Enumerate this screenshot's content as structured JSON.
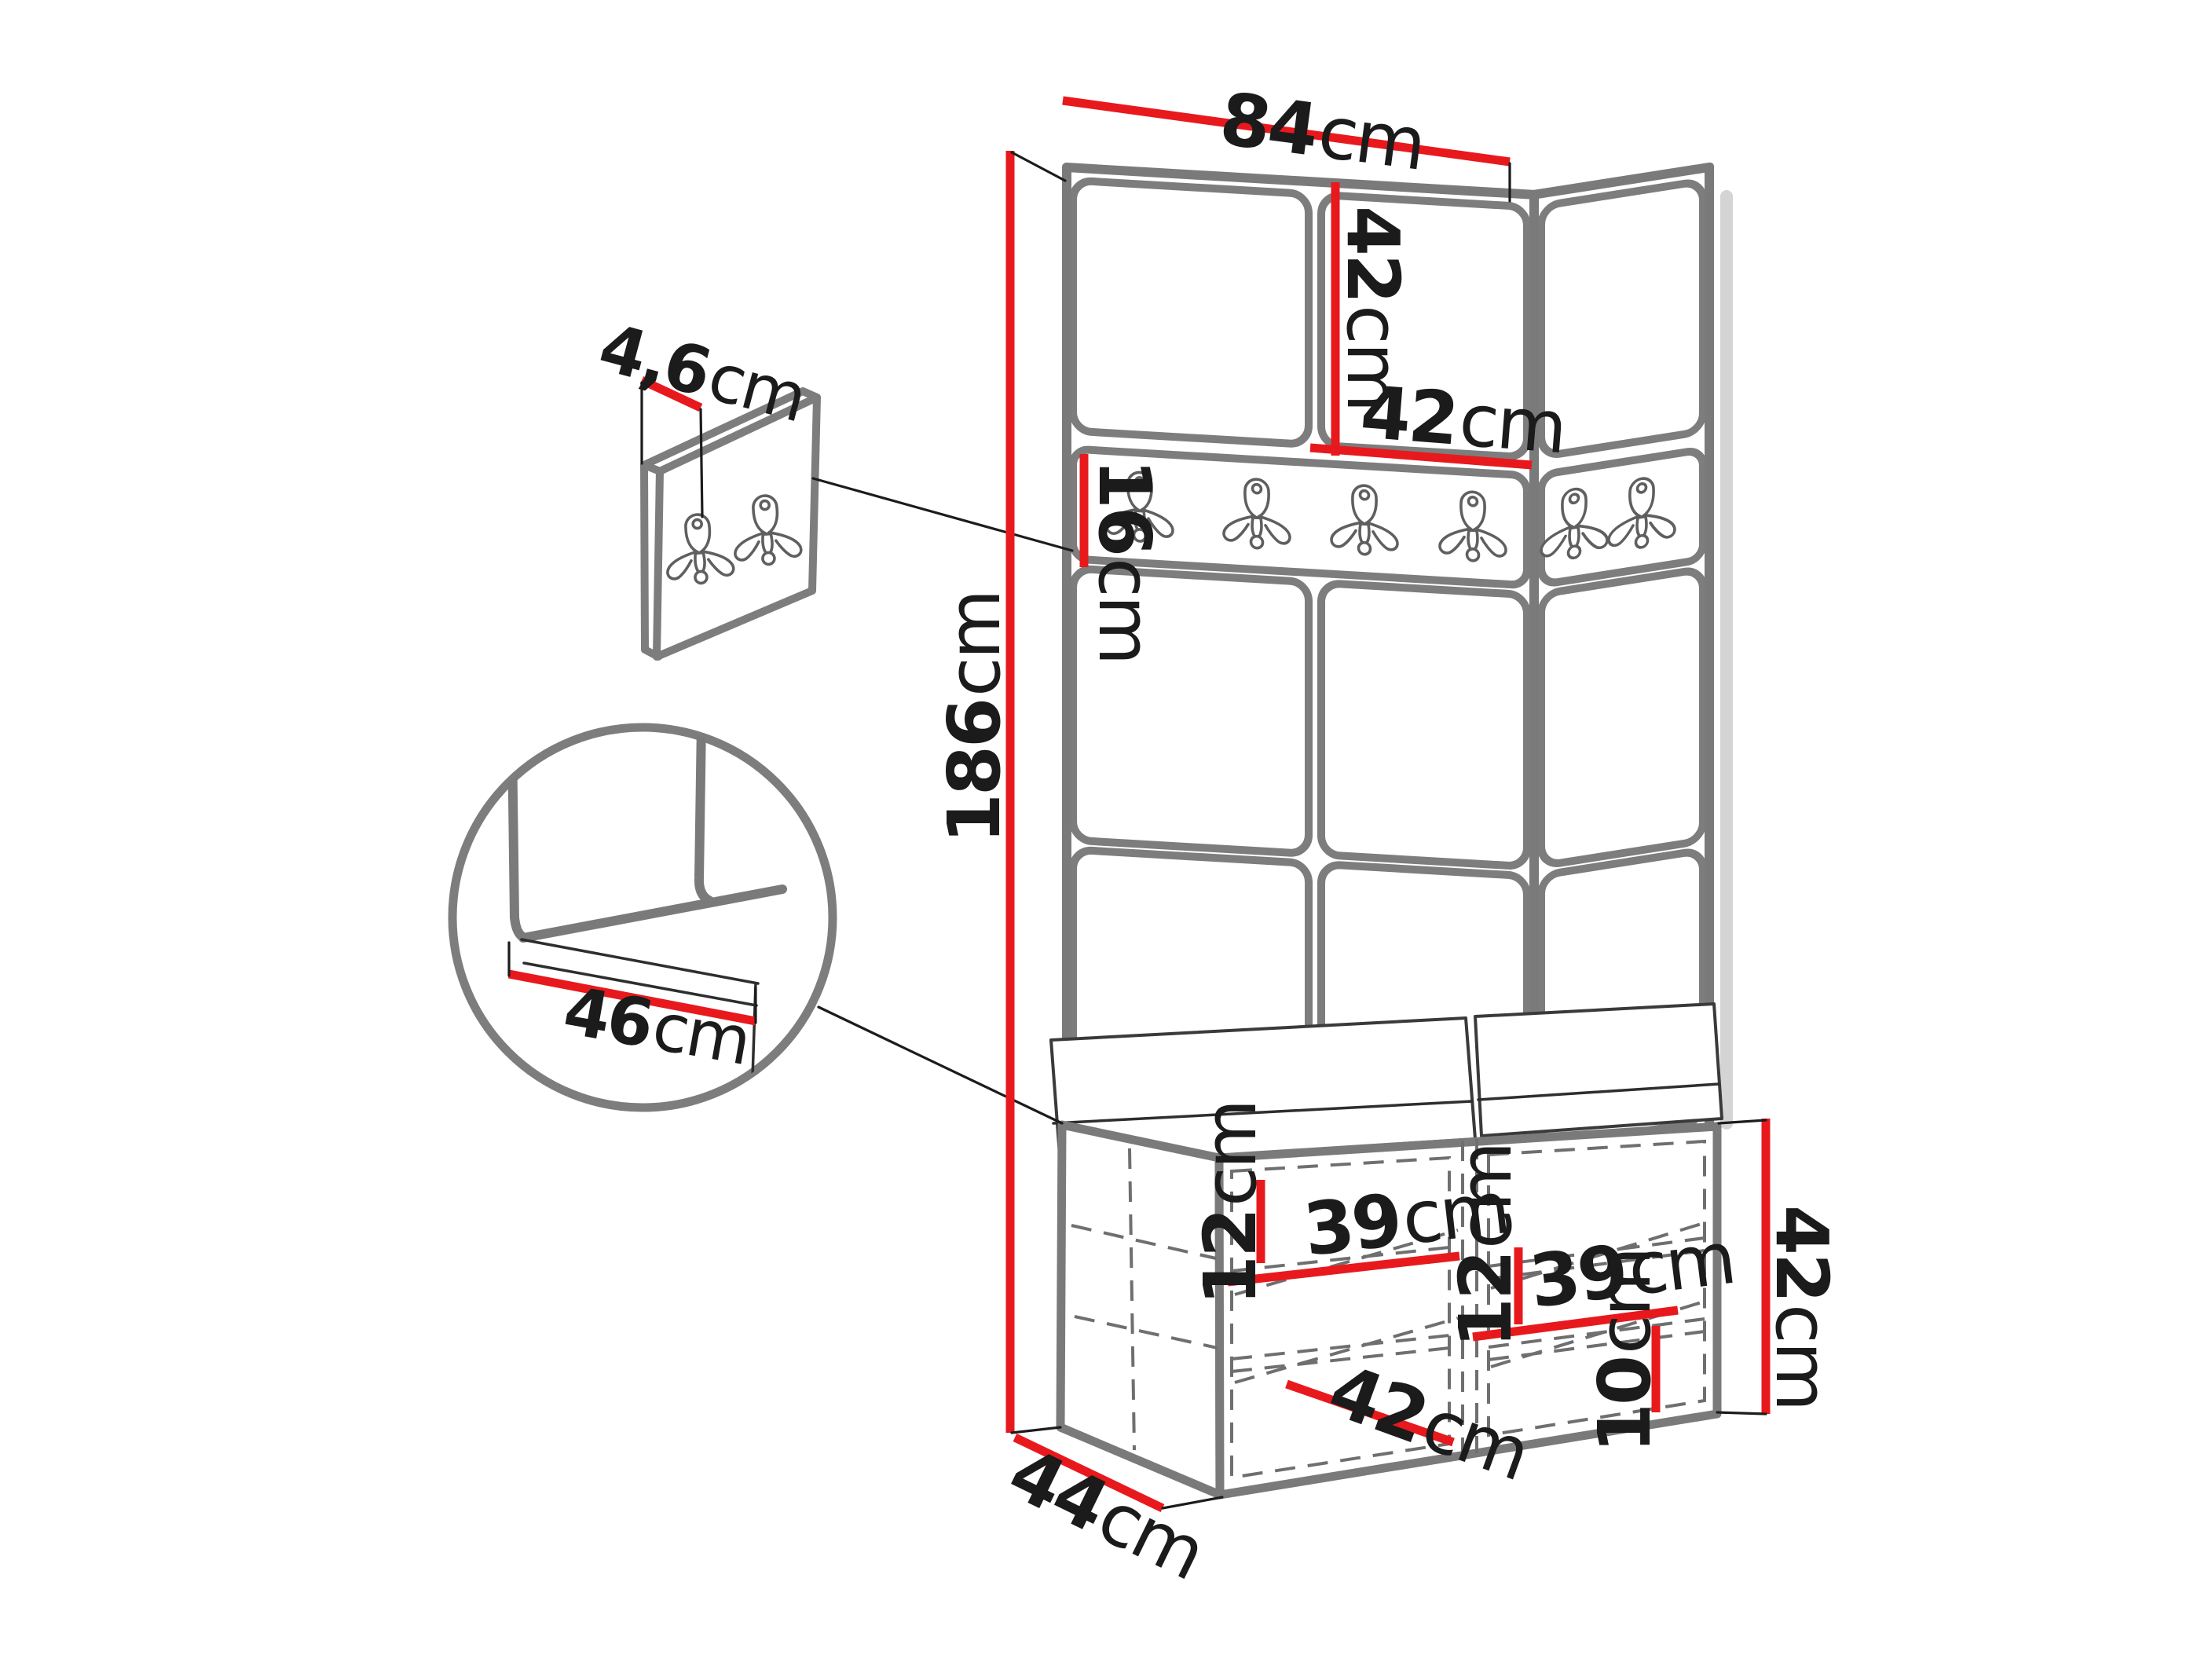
{
  "diagram": {
    "description": "Hallway furniture set (corner panel wardrobe with hook rail and storage bench) dimensional drawing",
    "colors": {
      "dimension_red": "#e8191d",
      "edge_gray": "#7a7a7a",
      "line_black": "#1c1c1c",
      "background": "#ffffff"
    },
    "labels": {
      "total_width": {
        "value": "84",
        "unit": "cm"
      },
      "top_panel_height": {
        "value": "42",
        "unit": "cm"
      },
      "top_panel_width": {
        "value": "42",
        "unit": "cm"
      },
      "hook_rail_height": {
        "value": "16",
        "unit": "cm"
      },
      "total_height": {
        "value": "186",
        "unit": "cm"
      },
      "wall_panel_thickness": {
        "value": "4,6",
        "unit": "cm"
      },
      "seat_depth": {
        "value": "46",
        "unit": "cm"
      },
      "left_shelf_offset": {
        "value": "12",
        "unit": "cm"
      },
      "left_compartment_width": {
        "value": "39",
        "unit": "cm"
      },
      "left_door_width": {
        "value": "42",
        "unit": "cm"
      },
      "right_shelf_offset": {
        "value": "12",
        "unit": "cm"
      },
      "right_compartment_width": {
        "value": "39",
        "unit": "cm"
      },
      "plinth_height": {
        "value": "10",
        "unit": "cm"
      },
      "bench_height": {
        "value": "42",
        "unit": "cm"
      },
      "bench_depth": {
        "value": "44",
        "unit": "cm"
      }
    },
    "hook_counts": {
      "wall_rail_front": 4,
      "wall_rail_side": 2,
      "small_panel": 2
    }
  }
}
